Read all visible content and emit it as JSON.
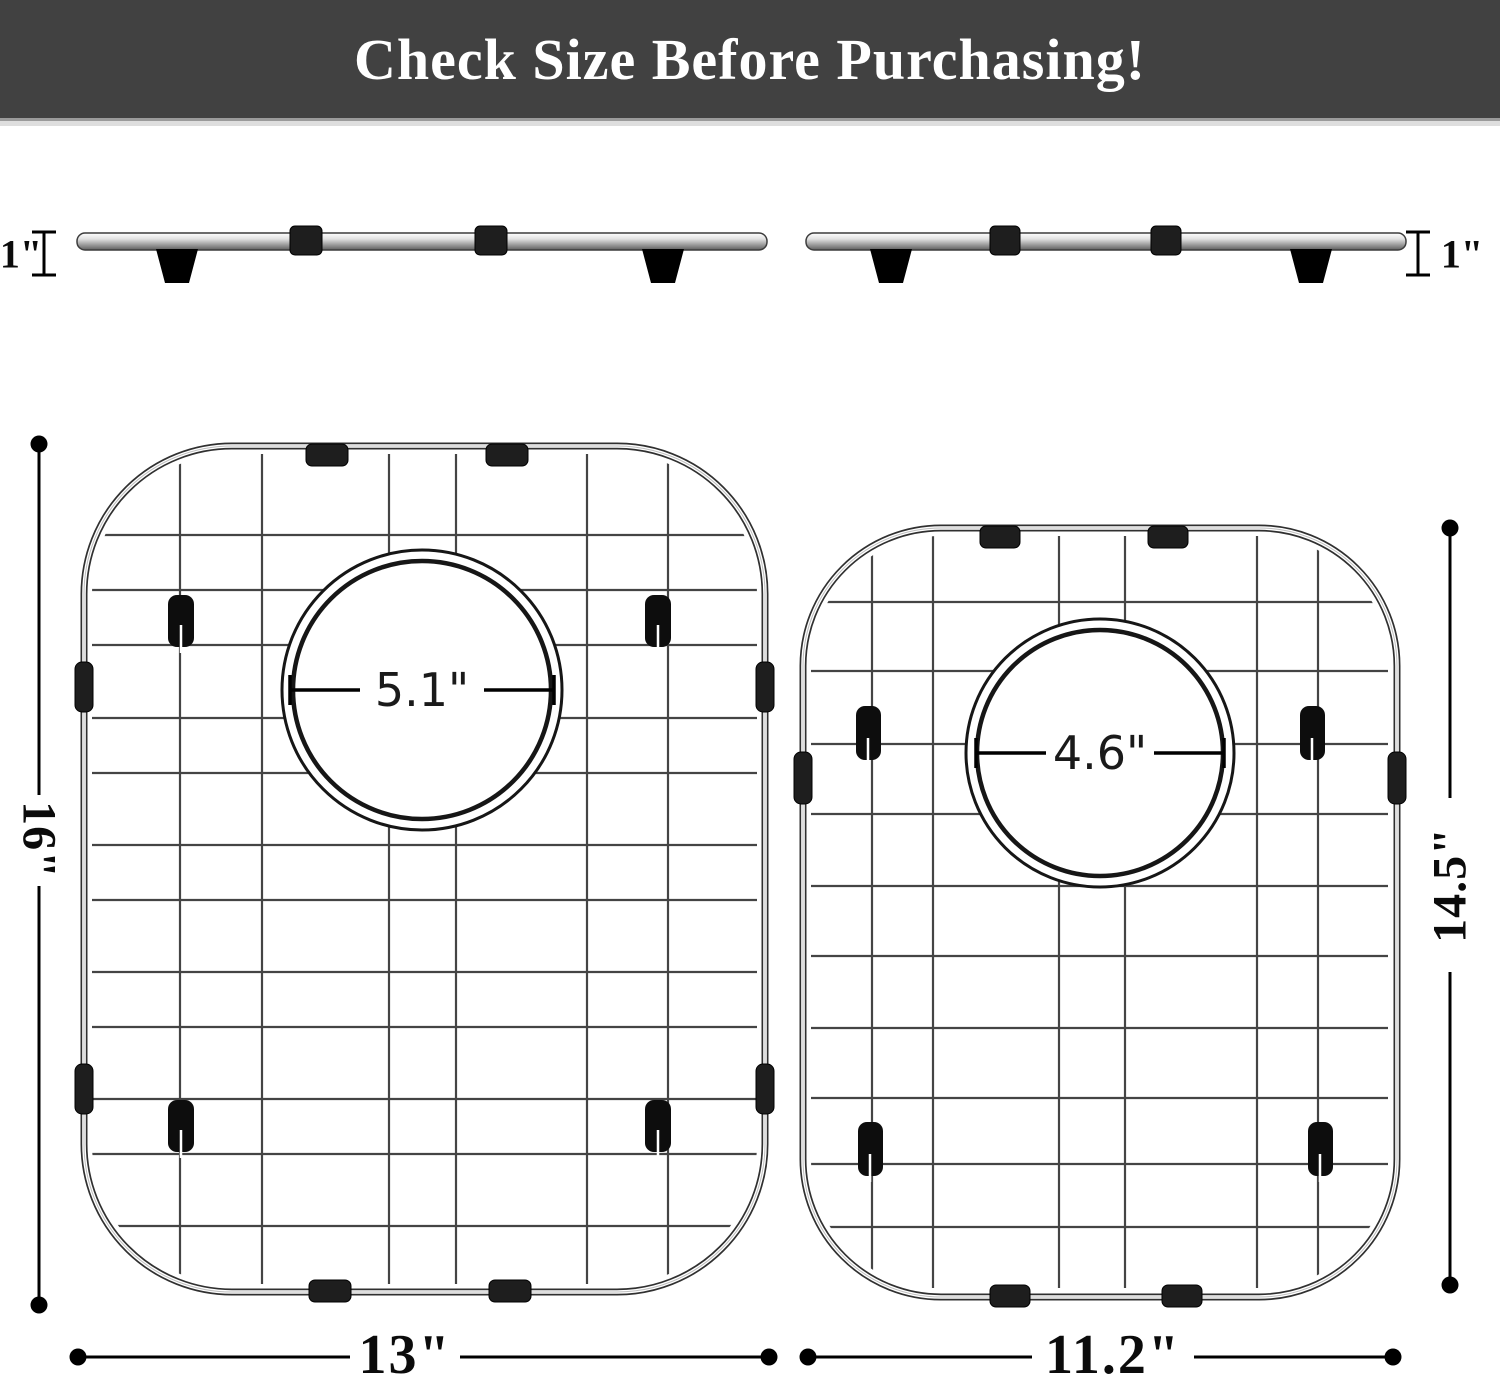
{
  "banner": {
    "title": "Check Size Before Purchasing!"
  },
  "side_view": {
    "left_height_label": "1\"",
    "right_height_label": "1\""
  },
  "grid_left": {
    "width_label": "13\"",
    "height_label": "16\"",
    "hole_diameter_label": "5.1\""
  },
  "grid_right": {
    "width_label": "11.2\"",
    "height_label": "14.5\"",
    "hole_diameter_label": "4.6\""
  },
  "colors": {
    "banner_bg": "#414141",
    "banner_text": "#ffffff",
    "dimension_line": "#000000",
    "wire": "#444444",
    "clip": "#1e1e1e"
  }
}
